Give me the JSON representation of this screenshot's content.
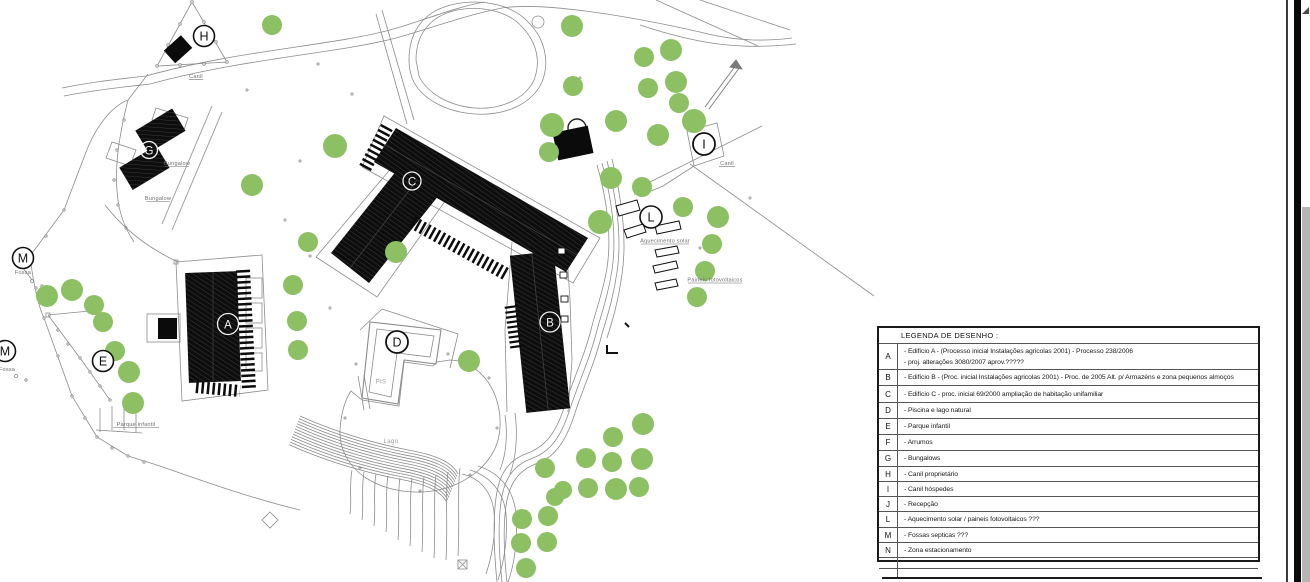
{
  "plan": {
    "colors": {
      "tree_green": "#8cc063",
      "linework_gray": "#8c8c8c",
      "building_black": "#0b0b0b"
    },
    "circled_labels": [
      {
        "letter": "H",
        "x": 204,
        "y": 36
      },
      {
        "letter": "G",
        "x": 149,
        "y": 150
      },
      {
        "letter": "A",
        "x": 228,
        "y": 324
      },
      {
        "letter": "C",
        "x": 412,
        "y": 181
      },
      {
        "letter": "B",
        "x": 550,
        "y": 322
      },
      {
        "letter": "D",
        "x": 397,
        "y": 342
      },
      {
        "letter": "E",
        "x": 103,
        "y": 361
      },
      {
        "letter": "I",
        "x": 704,
        "y": 144
      },
      {
        "letter": "L",
        "x": 651,
        "y": 217
      },
      {
        "letter": "M",
        "x": 23,
        "y": 258
      },
      {
        "letter": "M",
        "x": 5,
        "y": 351
      }
    ],
    "map_texts": [
      {
        "text": "Canil"
      },
      {
        "text": "Canil"
      },
      {
        "text": "Bungalow"
      },
      {
        "text": "Bungalow"
      },
      {
        "text": "Aquecimento solar"
      },
      {
        "text": "Paineis fotovoltaicos"
      },
      {
        "text": "Fossa"
      },
      {
        "text": "Fossa"
      },
      {
        "text": "Parque infantil"
      },
      {
        "text": "PIS"
      },
      {
        "text": "Lago"
      }
    ]
  },
  "legend": {
    "title": "LEGENDA DE DESENHO :",
    "rows": [
      {
        "key": "A",
        "line1": "- Edifício A - (Processo inicial Instalações agricolas 2001)   - Processo 238/2006",
        "line2": "- proj. alterações 3080/2007  aprov.?????"
      },
      {
        "key": "B",
        "line1": "- Edifício B - (Proc. inicial Instalações agricolas 2001)  - Proc. de 2005 Alt. p/ Armazéns e zona pequenos almoços"
      },
      {
        "key": "C",
        "line1": "- Edifício C - proc. inicial 69/2000  ampliação de habitação unifamiliar"
      },
      {
        "key": "D",
        "line1": "- Piscina e lago natural"
      },
      {
        "key": "E",
        "line1": "- Parque infantil"
      },
      {
        "key": "F",
        "line1": "- Arrumos"
      },
      {
        "key": "G",
        "line1": "- Bungalows"
      },
      {
        "key": "H",
        "line1": "- Canil proprietário"
      },
      {
        "key": "I",
        "line1": "- Canil hóspedes"
      },
      {
        "key": "J",
        "line1": "- Recepção"
      },
      {
        "key": "L",
        "line1": "- Aquecimento solar / paineis fotovoltaicos ???"
      },
      {
        "key": "M",
        "line1": "- Fossas septicas ???"
      },
      {
        "key": "N",
        "line1": "- Zona estacionamento"
      },
      {
        "key": "",
        "line1": ""
      },
      {
        "key": "",
        "line1": ""
      }
    ]
  }
}
